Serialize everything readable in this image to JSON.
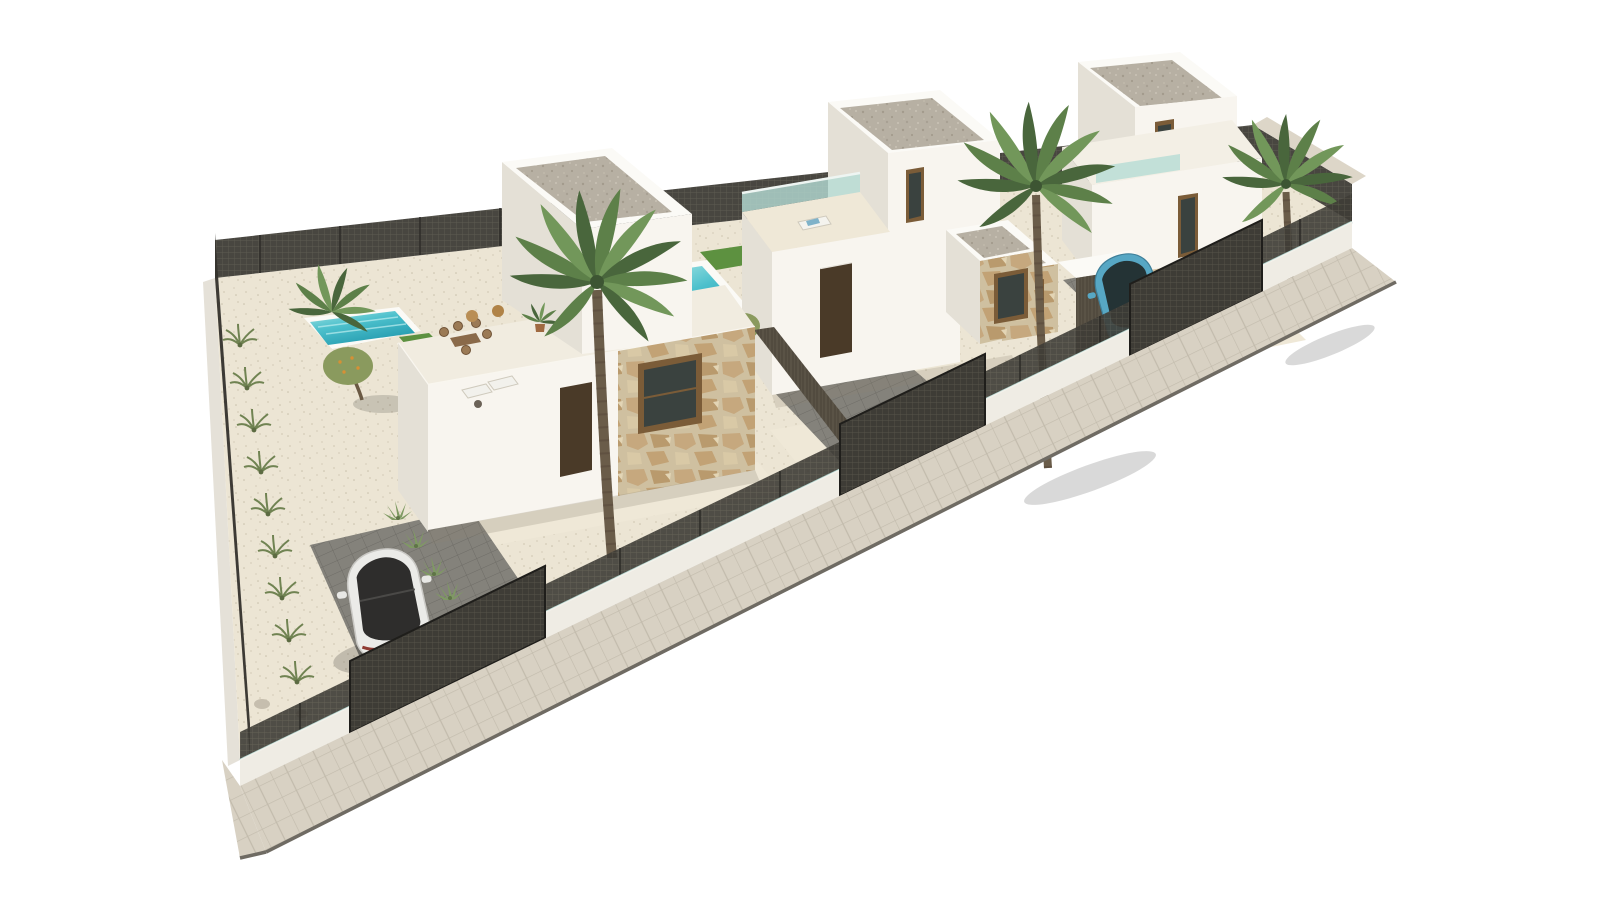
{
  "page": {
    "background": "#ffffff",
    "title": "Aerial 3D render – three new-build villas on a corner plot"
  },
  "scene": {
    "kind": "3D architectural exterior rendering, high aerial isometric view",
    "setting": "Long diagonal corner plot with three detached modern white villas, private pools, gravel gardens, dark metal mesh perimeter fencing and a beige paver sidewalk wrapping the plot",
    "background": "pure white, no sky or context"
  },
  "objects": {
    "villas": [
      {
        "id": "villa-1",
        "position": "left (largest garden)",
        "floors": 1,
        "features": [
          "two-storey stair tower with gravel flat roof",
          "roof terrace with dining table, five chairs, two poufs and potted palm",
          "turquoise pool with lawn edge and two sun loungers",
          "gravel garden with olive tree, shrubs and rocks along the left fence",
          "white facade with dark brown entrance door",
          "stone-clad facade section with brown-framed window",
          "dark paver driveway with parked white car",
          "full-height mesh entrance gate"
        ]
      },
      {
        "id": "villa-2",
        "position": "middle",
        "floors": 2,
        "features": [
          "upper floor with gravel flat roof and brown-framed window",
          "roof terrace with teal glass balustrade and white sun lounger",
          "turquoise pool with lawn strip",
          "white facade with dark brown entrance door",
          "stone-clad annex cube with gravel roof and window",
          "small olive tree and agaves",
          "paver driveway with mesh gate"
        ]
      },
      {
        "id": "villa-3",
        "position": "right",
        "floors": 2,
        "features": [
          "tall top volume with gravel flat roof and brown window",
          "first-floor terrace with teal glass strip",
          "tall brown window-door on mid level",
          "stone-clad ground floor with brown-framed windows",
          "stone annex cube",
          "dark garage recess",
          "driveway with parked blue car and mesh gate",
          "palm at the fenced corner terrace"
        ]
      }
    ],
    "vehicles": [
      {
        "id": "white-car",
        "type": "hatchback seen from above-behind, dark glass roof, red tail-light stripe",
        "color_key": "car_white",
        "location": "villa-1 driveway"
      },
      {
        "id": "blue-car",
        "type": "hatchback seen from above-behind, dark glass",
        "color_key": "car_blue",
        "location": "villa-3 driveway"
      }
    ],
    "vegetation": {
      "tall_palms": 3,
      "bushy_palm_by_pool": 1,
      "potted_palm_on_terrace": 1,
      "olive_trees": 2,
      "shrubs_along_left_fence": 9,
      "agaves_and_cacti": 8
    },
    "boundary": {
      "front": "low white wall with thin teal glass strip topped by dark mesh panels",
      "gates": 3,
      "back_and_sides": "full-height dark mesh fence",
      "sidewalk": "beige paver sidewalk with dark curb edge wrapping both plot corners"
    }
  },
  "palette": {
    "bg": "#ffffff",
    "wall_bright": "#f8f5ef",
    "wall_shade": "#e4e0d6",
    "wall_deep": "#d6d2c7",
    "parapet": "#fbfaf6",
    "gravel_roof": "#b7b0a3",
    "ground": "#ece5d4",
    "terrace": "#efe8d7",
    "paver_dark": "#84827b",
    "sidewalk": "#d8d1c3",
    "curb": "#6f6b63",
    "mesh": "#3e3c36",
    "mesh_line": "#565349",
    "pool_light": "#86d8dc",
    "pool_deep": "#2fa9bb",
    "lawn": "#5d9140",
    "stone_bg": "#cfc0a0",
    "wood_wall": "#5a5346",
    "door_brown": "#4a3a28",
    "frame_brown": "#7b5c38",
    "glass_dark": "#3a423f",
    "glass_teal": "#b5dcd4",
    "car_white": "#ebebe8",
    "car_blue": "#57a7c4",
    "car_glass": "#2e2d2c",
    "palm_dark": "#49663c",
    "palm_mid": "#5d8049",
    "palm_light": "#72975a",
    "palm_trunk": "#6a5c49",
    "olive": "#8a9a5e",
    "olive_fruit": "#d69035",
    "shrub": "#708352",
    "shadow": "#8d8474"
  }
}
